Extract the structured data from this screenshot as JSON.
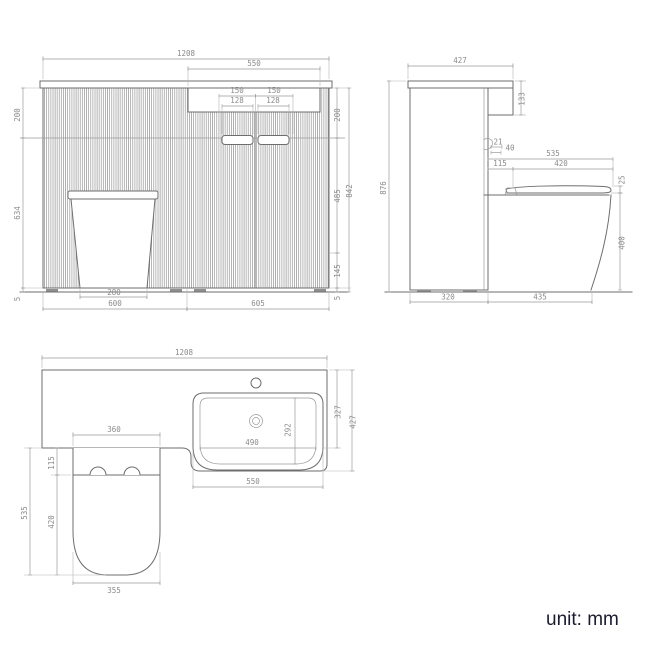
{
  "unit_label": "unit: mm",
  "colors": {
    "line": "#6e6e6e",
    "dim": "#9a9a9a",
    "dim_text": "#8a8a8a",
    "unit_text": "#1b1b30",
    "background": "#ffffff"
  },
  "views": {
    "front": {
      "overall_width": "1208",
      "recess_width": "550",
      "handle_pitch_left": "150",
      "handle_pitch_right": "150",
      "handle_width_left": "128",
      "handle_width_right": "128",
      "top_left": "200",
      "left_height": "634",
      "left_gap": "5",
      "top_right": "200",
      "door_height": "485",
      "base_height": "145",
      "right_gap": "5",
      "overall_height": "842",
      "toilet_base_width": "280",
      "left_section_width": "600",
      "right_section_width": "605"
    },
    "side": {
      "counter_depth": "427",
      "panel_height": "133",
      "hinge_offset": "21",
      "hinge_depth": "40",
      "overall_height": "876",
      "seat_total_depth": "535",
      "seat_back": "115",
      "seat_depth": "420",
      "seat_thickness": "25",
      "pan_height": "400",
      "cabinet_depth": "320",
      "pan_projection": "435"
    },
    "plan": {
      "overall_width": "1208",
      "basin_outer_width": "550",
      "basin_inner_width": "490",
      "basin_inner_depth": "292",
      "basin_front_offset": "327",
      "counter_depth": "427",
      "toilet_width": "360",
      "hinge_zone": "115",
      "toilet_depth": "535",
      "seat_depth": "420",
      "toilet_front_width": "355"
    }
  }
}
